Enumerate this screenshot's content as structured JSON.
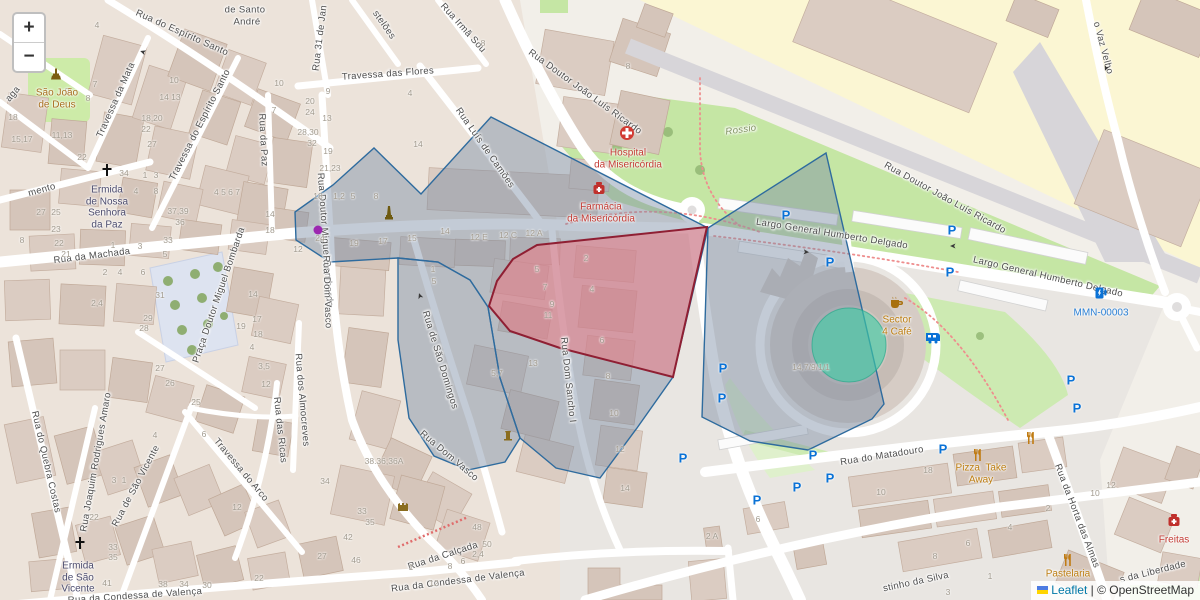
{
  "controls": {
    "zoom_in_label": "+",
    "zoom_out_label": "−"
  },
  "attribution": {
    "leaflet_link": "Leaflet",
    "separator": " | ",
    "osm_credit": "© OpenStreetMap"
  },
  "overlays": {
    "polygons": [
      {
        "name": "overlay-zone-central",
        "color": "blue",
        "points": [
          [
            295,
            212
          ],
          [
            333,
            185
          ],
          [
            374,
            148
          ],
          [
            421,
            194
          ],
          [
            491,
            117
          ],
          [
            708,
            228
          ],
          [
            673,
            377
          ],
          [
            637,
            428
          ],
          [
            600,
            478
          ],
          [
            556,
            468
          ],
          [
            520,
            438
          ],
          [
            500,
            378
          ],
          [
            488,
            307
          ],
          [
            470,
            280
          ],
          [
            438,
            262
          ],
          [
            398,
            258
          ],
          [
            330,
            262
          ],
          [
            296,
            240
          ]
        ]
      },
      {
        "name": "overlay-zone-sao-domingos",
        "color": "blue",
        "points": [
          [
            398,
            258
          ],
          [
            438,
            262
          ],
          [
            470,
            280
          ],
          [
            488,
            307
          ],
          [
            500,
            378
          ],
          [
            520,
            438
          ],
          [
            505,
            462
          ],
          [
            468,
            470
          ],
          [
            434,
            456
          ],
          [
            409,
            418
          ],
          [
            398,
            340
          ]
        ]
      },
      {
        "name": "overlay-zone-east",
        "color": "blue",
        "points": [
          [
            708,
            228
          ],
          [
            826,
            153
          ],
          [
            884,
            404
          ],
          [
            872,
            419
          ],
          [
            808,
            450
          ],
          [
            750,
            441
          ],
          [
            702,
            417
          ]
        ]
      },
      {
        "name": "overlay-zone-red",
        "color": "red",
        "points": [
          [
            489,
            306
          ],
          [
            497,
            281
          ],
          [
            513,
            259
          ],
          [
            537,
            245
          ],
          [
            707,
            227
          ],
          [
            673,
            377
          ],
          [
            560,
            348
          ],
          [
            510,
            331
          ]
        ]
      }
    ],
    "circle": {
      "name": "overlay-roundabout-circle",
      "cx": 849,
      "cy": 345,
      "r": 37
    }
  },
  "street_labels": [
    {
      "t": "Rua do Espírito Santo",
      "x": 182,
      "y": 33,
      "r": 24
    },
    {
      "t": "Travessa do Espírito Santo",
      "x": 200,
      "y": 125,
      "r": -63
    },
    {
      "t": "Travessa da Mata",
      "x": 116,
      "y": 100,
      "r": -66
    },
    {
      "t": "Travessa das Flores",
      "x": 388,
      "y": 74,
      "r": -4
    },
    {
      "t": "Rua 31 de Jan",
      "x": 320,
      "y": 38,
      "r": -83
    },
    {
      "t": "stelões",
      "x": 384,
      "y": 25,
      "r": 55
    },
    {
      "t": "Rua Irmã Sou",
      "x": 463,
      "y": 28,
      "r": 48
    },
    {
      "t": "Rua Luís de Camões",
      "x": 485,
      "y": 148,
      "r": 55
    },
    {
      "t": "Rua Doutor João Luís Ricardo",
      "x": 585,
      "y": 92,
      "r": 36
    },
    {
      "t": "Rua Doutor João Luís Ricardo",
      "x": 945,
      "y": 198,
      "r": 29
    },
    {
      "t": "o Vaz Velho",
      "x": 1103,
      "y": 48,
      "r": 75
    },
    {
      "t": "Largo General Humberto Delgado",
      "x": 832,
      "y": 234,
      "r": 9
    },
    {
      "t": "Largo General Humberto Delgado",
      "x": 1048,
      "y": 277,
      "r": 13
    },
    {
      "t": "Rossio",
      "x": 741,
      "y": 130,
      "r": -8,
      "i": 1,
      "c": "#7d8f5c"
    },
    {
      "t": "Rua da Paz",
      "x": 263,
      "y": 140,
      "r": 87
    },
    {
      "t": "Rua Doutor Miguel Bombarda",
      "x": 325,
      "y": 240,
      "r": 86
    },
    {
      "t": "Praça Doutor Miguel Bombarda",
      "x": 219,
      "y": 295,
      "r": -71
    },
    {
      "t": "Rua da Machada",
      "x": 92,
      "y": 256,
      "r": -7
    },
    {
      "t": "mento",
      "x": 42,
      "y": 190,
      "r": -16
    },
    {
      "t": "aga",
      "x": 13,
      "y": 94,
      "r": -50
    },
    {
      "t": "Rua do Quebra Costas",
      "x": 46,
      "y": 462,
      "r": 77
    },
    {
      "t": "Rua Joaquim Rodrigues Amaro",
      "x": 96,
      "y": 462,
      "r": -80
    },
    {
      "t": "Rua de São Vicente",
      "x": 136,
      "y": 486,
      "r": -62
    },
    {
      "t": "Travessa do Arco",
      "x": 241,
      "y": 470,
      "r": 50
    },
    {
      "t": "Rua das Ricas",
      "x": 280,
      "y": 430,
      "r": 84
    },
    {
      "t": "Rua dos Almocreves",
      "x": 302,
      "y": 400,
      "r": 85
    },
    {
      "t": "Rua Dom Vasco",
      "x": 327,
      "y": 292,
      "r": 88
    },
    {
      "t": "Rua Dom Vasco",
      "x": 449,
      "y": 456,
      "r": 40
    },
    {
      "t": "Rua de São Domingos",
      "x": 440,
      "y": 360,
      "r": 73
    },
    {
      "t": "Rua Dom Sancho I",
      "x": 568,
      "y": 380,
      "r": 84
    },
    {
      "t": "Rua da Calçada",
      "x": 443,
      "y": 556,
      "r": -18
    },
    {
      "t": "Rua da Condessa de Valença",
      "x": 135,
      "y": 596,
      "r": -4
    },
    {
      "t": "Rua da Condessa de Valença",
      "x": 458,
      "y": 581,
      "r": -7
    },
    {
      "t": "Rua do Matadouro",
      "x": 882,
      "y": 456,
      "r": -9
    },
    {
      "t": "Rua da Horta das Almas",
      "x": 1077,
      "y": 516,
      "r": 69
    },
    {
      "t": "stinho da Silva",
      "x": 916,
      "y": 582,
      "r": -12
    },
    {
      "t": "s da Liberdade",
      "x": 1153,
      "y": 572,
      "r": -14
    },
    {
      "t": "de Santo",
      "x": 245,
      "y": 10,
      "r": 0
    },
    {
      "t": "André",
      "x": 247,
      "y": 22,
      "r": 0
    }
  ],
  "poi_labels": [
    {
      "icon": "statue",
      "ix": 56,
      "iy": 75,
      "lines": [
        "São João",
        "de Deus"
      ],
      "lx": 57,
      "ly": 93,
      "c": "#a86f1f"
    },
    {
      "icon": "cross",
      "ix": 107,
      "iy": 170,
      "lines": [
        "Ermida",
        "de Nossa",
        "Senhora",
        "da Paz"
      ],
      "lx": 107,
      "ly": 190,
      "c": "#4c4c6e"
    },
    {
      "icon": "hospital",
      "ix": 627,
      "iy": 133,
      "lines": [
        "Hospital",
        "da Misericórdia"
      ],
      "lx": 628,
      "ly": 153,
      "c": "#c43c35"
    },
    {
      "icon": "pharmacy",
      "ix": 599,
      "iy": 188,
      "lines": [
        "Farmácia",
        "da Misericórdia"
      ],
      "lx": 601,
      "ly": 207,
      "c": "#c43c35"
    },
    {
      "icon": "monument",
      "ix": 389,
      "iy": 213,
      "lines": [],
      "lx": 0,
      "ly": 0,
      "c": ""
    },
    {
      "icon": "coffee",
      "ix": 897,
      "iy": 303,
      "lines": [
        "Sector",
        "4 Café"
      ],
      "lx": 897,
      "ly": 320,
      "c": "#bc7d10"
    },
    {
      "icon": "ev",
      "ix": 1101,
      "iy": 293,
      "lines": [
        "MMN-00003"
      ],
      "lx": 1101,
      "ly": 313,
      "c": "#2a7fd4"
    },
    {
      "icon": "restaurant",
      "ix": 978,
      "iy": 455,
      "lines": [
        "Pizza  Take",
        "Away"
      ],
      "lx": 981,
      "ly": 468,
      "c": "#bc7d10"
    },
    {
      "icon": "restaurant",
      "ix": 1031,
      "iy": 438,
      "lines": [],
      "lx": 0,
      "ly": 0,
      "c": ""
    },
    {
      "icon": "restaurant",
      "ix": 1068,
      "iy": 560,
      "lines": [
        "Pastelaria"
      ],
      "lx": 1068,
      "ly": 574,
      "c": "#bc7d10"
    },
    {
      "icon": "pharmacy",
      "ix": 1174,
      "iy": 520,
      "lines": [
        "Freitas"
      ],
      "lx": 1174,
      "ly": 540,
      "c": "#c43c35"
    },
    {
      "icon": "cross",
      "ix": 80,
      "iy": 543,
      "lines": [
        "Ermida",
        "de São",
        "Vicente"
      ],
      "lx": 78,
      "ly": 566,
      "c": "#4c4c6e"
    },
    {
      "icon": "caravan",
      "ix": 933,
      "iy": 338,
      "lines": [],
      "lx": 0,
      "ly": 0,
      "c": ""
    },
    {
      "icon": "dot",
      "ix": 318,
      "iy": 230,
      "lines": [],
      "lx": 0,
      "ly": 0,
      "c": ""
    },
    {
      "icon": "castle",
      "ix": 403,
      "iy": 506,
      "lines": [],
      "lx": 0,
      "ly": 0,
      "c": ""
    },
    {
      "icon": "fountain",
      "ix": 508,
      "iy": 435,
      "lines": [],
      "lx": 0,
      "ly": 0,
      "c": ""
    }
  ],
  "house_numbers": [
    {
      "t": "4",
      "x": 97,
      "y": 25
    },
    {
      "t": "7",
      "x": 95,
      "y": 84
    },
    {
      "t": "8",
      "x": 88,
      "y": 98
    },
    {
      "t": "9",
      "x": 67,
      "y": 91
    },
    {
      "t": "10",
      "x": 174,
      "y": 80
    },
    {
      "t": "14 13",
      "x": 170,
      "y": 97
    },
    {
      "t": "18,20",
      "x": 152,
      "y": 118
    },
    {
      "t": "22",
      "x": 146,
      "y": 129
    },
    {
      "t": "27",
      "x": 152,
      "y": 144
    },
    {
      "t": "34",
      "x": 124,
      "y": 173
    },
    {
      "t": "11,13",
      "x": 62,
      "y": 135
    },
    {
      "t": "15,17",
      "x": 22,
      "y": 139
    },
    {
      "t": "18",
      "x": 13,
      "y": 117
    },
    {
      "t": "22",
      "x": 82,
      "y": 157
    },
    {
      "t": "27",
      "x": 41,
      "y": 212
    },
    {
      "t": "25",
      "x": 56,
      "y": 212
    },
    {
      "t": "23",
      "x": 56,
      "y": 229
    },
    {
      "t": "1",
      "x": 145,
      "y": 175
    },
    {
      "t": "3",
      "x": 156,
      "y": 175
    },
    {
      "t": "4",
      "x": 136,
      "y": 191
    },
    {
      "t": "8",
      "x": 156,
      "y": 191
    },
    {
      "t": "37,39",
      "x": 178,
      "y": 211
    },
    {
      "t": "36",
      "x": 180,
      "y": 222
    },
    {
      "t": "4 5 6 7",
      "x": 227,
      "y": 192
    },
    {
      "t": "10",
      "x": 279,
      "y": 83
    },
    {
      "t": "20",
      "x": 310,
      "y": 101
    },
    {
      "t": "24",
      "x": 310,
      "y": 112
    },
    {
      "t": "7",
      "x": 274,
      "y": 110
    },
    {
      "t": "13",
      "x": 327,
      "y": 118
    },
    {
      "t": "28,30",
      "x": 308,
      "y": 132
    },
    {
      "t": "32",
      "x": 312,
      "y": 143
    },
    {
      "t": "19",
      "x": 328,
      "y": 151
    },
    {
      "t": "21,23",
      "x": 330,
      "y": 168
    },
    {
      "t": "18",
      "x": 318,
      "y": 196
    },
    {
      "t": "24",
      "x": 320,
      "y": 238
    },
    {
      "t": "14",
      "x": 270,
      "y": 214
    },
    {
      "t": "18",
      "x": 270,
      "y": 230
    },
    {
      "t": "12",
      "x": 298,
      "y": 249
    },
    {
      "t": "8",
      "x": 483,
      "y": 43
    },
    {
      "t": "4",
      "x": 410,
      "y": 93
    },
    {
      "t": "14",
      "x": 418,
      "y": 144
    },
    {
      "t": "9",
      "x": 328,
      "y": 91
    },
    {
      "t": "8",
      "x": 628,
      "y": 66
    },
    {
      "t": "1,2",
      "x": 339,
      "y": 196
    },
    {
      "t": "5",
      "x": 353,
      "y": 196
    },
    {
      "t": "8",
      "x": 376,
      "y": 196
    },
    {
      "t": "14",
      "x": 445,
      "y": 231
    },
    {
      "t": "12 E",
      "x": 479,
      "y": 237
    },
    {
      "t": "12 C",
      "x": 508,
      "y": 235
    },
    {
      "t": "12 A",
      "x": 534,
      "y": 233
    },
    {
      "t": "19",
      "x": 354,
      "y": 243
    },
    {
      "t": "17",
      "x": 383,
      "y": 241
    },
    {
      "t": "15",
      "x": 412,
      "y": 238
    },
    {
      "t": "1",
      "x": 433,
      "y": 269
    },
    {
      "t": "5",
      "x": 434,
      "y": 281
    },
    {
      "t": "2",
      "x": 586,
      "y": 258
    },
    {
      "t": "5",
      "x": 537,
      "y": 269
    },
    {
      "t": "7",
      "x": 545,
      "y": 287
    },
    {
      "t": "9",
      "x": 552,
      "y": 304
    },
    {
      "t": "11",
      "x": 548,
      "y": 315
    },
    {
      "t": "4",
      "x": 592,
      "y": 289
    },
    {
      "t": "6",
      "x": 602,
      "y": 340
    },
    {
      "t": "8",
      "x": 608,
      "y": 376
    },
    {
      "t": "10",
      "x": 614,
      "y": 413
    },
    {
      "t": "12",
      "x": 620,
      "y": 449
    },
    {
      "t": "14",
      "x": 625,
      "y": 488
    },
    {
      "t": "13",
      "x": 533,
      "y": 363
    },
    {
      "t": "5,7",
      "x": 497,
      "y": 373
    },
    {
      "t": "38.36;36A",
      "x": 384,
      "y": 461
    },
    {
      "t": "34",
      "x": 325,
      "y": 481
    },
    {
      "t": "33",
      "x": 362,
      "y": 511
    },
    {
      "t": "35",
      "x": 370,
      "y": 522
    },
    {
      "t": "42",
      "x": 348,
      "y": 537
    },
    {
      "t": "27",
      "x": 322,
      "y": 556
    },
    {
      "t": "46",
      "x": 356,
      "y": 560
    },
    {
      "t": "1",
      "x": 411,
      "y": 567
    },
    {
      "t": "12",
      "x": 434,
      "y": 583
    },
    {
      "t": "48",
      "x": 477,
      "y": 527
    },
    {
      "t": "50",
      "x": 487,
      "y": 544
    },
    {
      "t": "2,4",
      "x": 478,
      "y": 554
    },
    {
      "t": "6",
      "x": 463,
      "y": 561
    },
    {
      "t": "8",
      "x": 450,
      "y": 566
    },
    {
      "t": "41",
      "x": 107,
      "y": 583
    },
    {
      "t": "33",
      "x": 113,
      "y": 547
    },
    {
      "t": "35",
      "x": 113,
      "y": 557
    },
    {
      "t": "22",
      "x": 94,
      "y": 517
    },
    {
      "t": "3",
      "x": 114,
      "y": 480
    },
    {
      "t": "1",
      "x": 124,
      "y": 480
    },
    {
      "t": "38",
      "x": 163,
      "y": 584
    },
    {
      "t": "34",
      "x": 184,
      "y": 584
    },
    {
      "t": "30",
      "x": 207,
      "y": 585
    },
    {
      "t": "22",
      "x": 259,
      "y": 578
    },
    {
      "t": "12",
      "x": 237,
      "y": 507
    },
    {
      "t": "6",
      "x": 204,
      "y": 434
    },
    {
      "t": "4",
      "x": 155,
      "y": 435
    },
    {
      "t": "8",
      "x": 22,
      "y": 240
    },
    {
      "t": "22",
      "x": 59,
      "y": 243
    },
    {
      "t": "21",
      "x": 66,
      "y": 254
    },
    {
      "t": "1",
      "x": 113,
      "y": 245
    },
    {
      "t": "3",
      "x": 140,
      "y": 246
    },
    {
      "t": "33",
      "x": 168,
      "y": 240
    },
    {
      "t": "5",
      "x": 165,
      "y": 254
    },
    {
      "t": "2",
      "x": 105,
      "y": 272
    },
    {
      "t": "4",
      "x": 120,
      "y": 272
    },
    {
      "t": "6",
      "x": 143,
      "y": 272
    },
    {
      "t": "31",
      "x": 160,
      "y": 295
    },
    {
      "t": "2,4",
      "x": 97,
      "y": 303
    },
    {
      "t": "29",
      "x": 148,
      "y": 318
    },
    {
      "t": "28",
      "x": 144,
      "y": 328
    },
    {
      "t": "27",
      "x": 160,
      "y": 368
    },
    {
      "t": "26",
      "x": 170,
      "y": 383
    },
    {
      "t": "25",
      "x": 196,
      "y": 402
    },
    {
      "t": "14",
      "x": 253,
      "y": 294
    },
    {
      "t": "17",
      "x": 257,
      "y": 319
    },
    {
      "t": "18",
      "x": 258,
      "y": 334
    },
    {
      "t": "19",
      "x": 241,
      "y": 326
    },
    {
      "t": "4",
      "x": 252,
      "y": 347
    },
    {
      "t": "3,5",
      "x": 264,
      "y": 366
    },
    {
      "t": "12",
      "x": 266,
      "y": 384
    },
    {
      "t": "14,7/9/1/1",
      "x": 811,
      "y": 367
    },
    {
      "t": "2 A",
      "x": 712,
      "y": 536
    },
    {
      "t": "6",
      "x": 758,
      "y": 519
    },
    {
      "t": "18",
      "x": 928,
      "y": 470
    },
    {
      "t": "10",
      "x": 881,
      "y": 492
    },
    {
      "t": "2",
      "x": 1048,
      "y": 508
    },
    {
      "t": "4",
      "x": 1010,
      "y": 527
    },
    {
      "t": "6",
      "x": 968,
      "y": 543
    },
    {
      "t": "8",
      "x": 935,
      "y": 556
    },
    {
      "t": "1",
      "x": 990,
      "y": 576
    },
    {
      "t": "3",
      "x": 948,
      "y": 592
    },
    {
      "t": "12",
      "x": 1111,
      "y": 485
    },
    {
      "t": "10",
      "x": 1095,
      "y": 493
    }
  ],
  "parking_icons": [
    {
      "x": 786,
      "y": 215
    },
    {
      "x": 830,
      "y": 262
    },
    {
      "x": 952,
      "y": 230
    },
    {
      "x": 950,
      "y": 272
    },
    {
      "x": 723,
      "y": 368
    },
    {
      "x": 722,
      "y": 398
    },
    {
      "x": 813,
      "y": 455
    },
    {
      "x": 797,
      "y": 487
    },
    {
      "x": 757,
      "y": 500
    },
    {
      "x": 683,
      "y": 458
    },
    {
      "x": 1071,
      "y": 380
    },
    {
      "x": 1077,
      "y": 408
    },
    {
      "x": 943,
      "y": 449
    },
    {
      "x": 830,
      "y": 478
    }
  ],
  "arrows": [
    {
      "x": 143,
      "y": 52,
      "r": 200
    },
    {
      "x": 806,
      "y": 252,
      "r": 5
    },
    {
      "x": 953,
      "y": 246,
      "r": 180
    },
    {
      "x": 1106,
      "y": 68,
      "r": 112
    },
    {
      "x": 420,
      "y": 296,
      "r": 250
    }
  ]
}
